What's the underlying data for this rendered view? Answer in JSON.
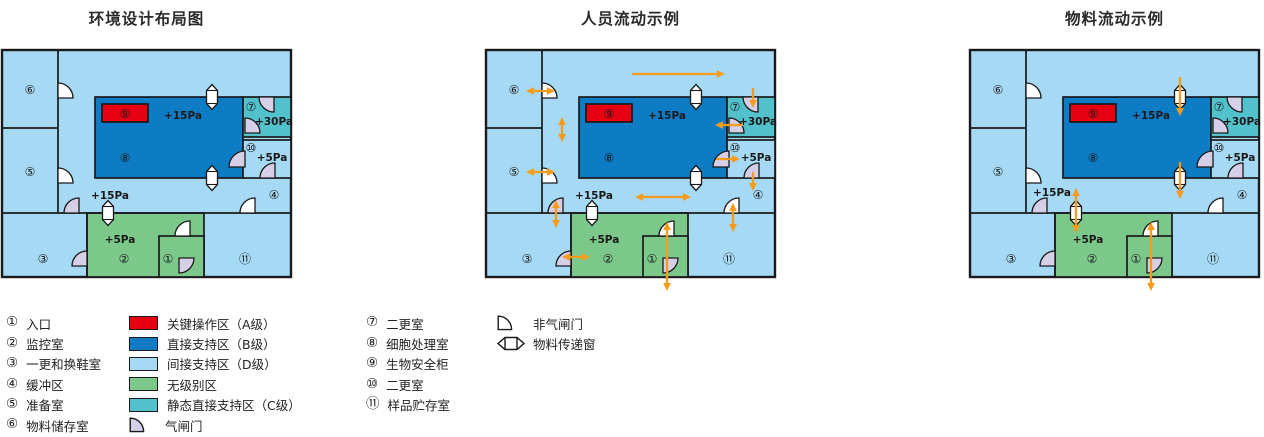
{
  "colors": {
    "light_blue": "#A6D9F3",
    "dark_blue": "#0E7CC4",
    "teal": "#52C1CB",
    "green": "#7CC88A",
    "red": "#E60012",
    "door_lavender": "#D6CFE8",
    "door_white": "#FFFFFF",
    "wall": "#1A1A1A",
    "arrow_orange": "#F59C1C",
    "text": "#1A1A1A"
  },
  "room_numbers": {
    "r1": "①",
    "r2": "②",
    "r3": "③",
    "r4": "④",
    "r5": "⑤",
    "r6": "⑥",
    "r7": "⑦",
    "r8": "⑧",
    "r9": "⑨",
    "r10": "⑩",
    "r11": "⑪"
  },
  "pressure_labels": {
    "dark_room": "+15Pa",
    "corridor": "+15Pa",
    "teal_room": "+30Pa",
    "room10": "+5Pa",
    "green_room": "+5Pa"
  },
  "plans": [
    {
      "id": "environment-layout",
      "title": "环境设计布局图",
      "corridor_label_pos": {
        "x": 108,
        "y": 145
      },
      "arrows": []
    },
    {
      "id": "personnel-flow",
      "title": "人员流动示例",
      "corridor_label_pos": {
        "x": 108,
        "y": 145
      },
      "arrows": [
        {
          "x1": 146,
          "y1": 24,
          "x2": 239,
          "y2": 24,
          "heads": "end"
        },
        {
          "x1": 40,
          "y1": 41,
          "x2": 69,
          "y2": 41,
          "heads": "both"
        },
        {
          "x1": 76,
          "y1": 67,
          "x2": 76,
          "y2": 92,
          "heads": "both"
        },
        {
          "x1": 40,
          "y1": 122,
          "x2": 69,
          "y2": 122,
          "heads": "both"
        },
        {
          "x1": 257,
          "y1": 75,
          "x2": 229,
          "y2": 75,
          "heads": "end"
        },
        {
          "x1": 267,
          "y1": 38,
          "x2": 267,
          "y2": 58,
          "heads": "end"
        },
        {
          "x1": 230,
          "y1": 109,
          "x2": 254,
          "y2": 109,
          "heads": "end"
        },
        {
          "x1": 267,
          "y1": 122,
          "x2": 267,
          "y2": 141,
          "heads": "end"
        },
        {
          "x1": 149,
          "y1": 147,
          "x2": 205,
          "y2": 147,
          "heads": "both"
        },
        {
          "x1": 247,
          "y1": 153,
          "x2": 247,
          "y2": 182,
          "heads": "both"
        },
        {
          "x1": 70,
          "y1": 150,
          "x2": 70,
          "y2": 178,
          "heads": "both"
        },
        {
          "x1": 76,
          "y1": 207,
          "x2": 104,
          "y2": 207,
          "heads": "both"
        },
        {
          "x1": 181,
          "y1": 172,
          "x2": 181,
          "y2": 241,
          "heads": "both"
        }
      ]
    },
    {
      "id": "material-flow",
      "title": "物料流动示例",
      "corridor_label_pos": {
        "x": 82,
        "y": 142
      },
      "arrows": [
        {
          "x1": 210,
          "y1": 27,
          "x2": 210,
          "y2": 66,
          "heads": "end"
        },
        {
          "x1": 210,
          "y1": 112,
          "x2": 210,
          "y2": 149,
          "heads": "end"
        },
        {
          "x1": 106,
          "y1": 138,
          "x2": 106,
          "y2": 183,
          "heads": "both"
        },
        {
          "x1": 181,
          "y1": 172,
          "x2": 181,
          "y2": 241,
          "heads": "both"
        }
      ]
    }
  ],
  "legend": {
    "col1": [
      {
        "num": "①",
        "label": "入口"
      },
      {
        "num": "②",
        "label": "监控室"
      },
      {
        "num": "③",
        "label": "一更和换鞋室"
      },
      {
        "num": "④",
        "label": "缓冲区"
      },
      {
        "num": "⑤",
        "label": "准备室"
      },
      {
        "num": "⑥",
        "label": "物料储存室"
      }
    ],
    "col2": [
      {
        "color": "red",
        "label": "关键操作区（A级）"
      },
      {
        "color": "dark_blue",
        "label": "直接支持区（B级）"
      },
      {
        "color": "light_blue",
        "label": "间接支持区（D级）"
      },
      {
        "color": "green",
        "label": "无级别区"
      },
      {
        "color": "teal",
        "label": "静态直接支持区（C级）"
      },
      {
        "icon": "airlock-door",
        "label": "气闸门"
      }
    ],
    "col3": [
      {
        "num": "⑦",
        "label": "二更室"
      },
      {
        "num": "⑧",
        "label": "细胞处理室"
      },
      {
        "num": "⑨",
        "label": "生物安全柜"
      },
      {
        "num": "⑩",
        "label": "二更室"
      },
      {
        "num": "⑪",
        "label": "样品贮存室"
      }
    ],
    "col4": [
      {
        "icon": "non-airlock-door",
        "label": "非气闸门"
      },
      {
        "icon": "transfer-window",
        "label": "物料传递窗"
      }
    ]
  }
}
